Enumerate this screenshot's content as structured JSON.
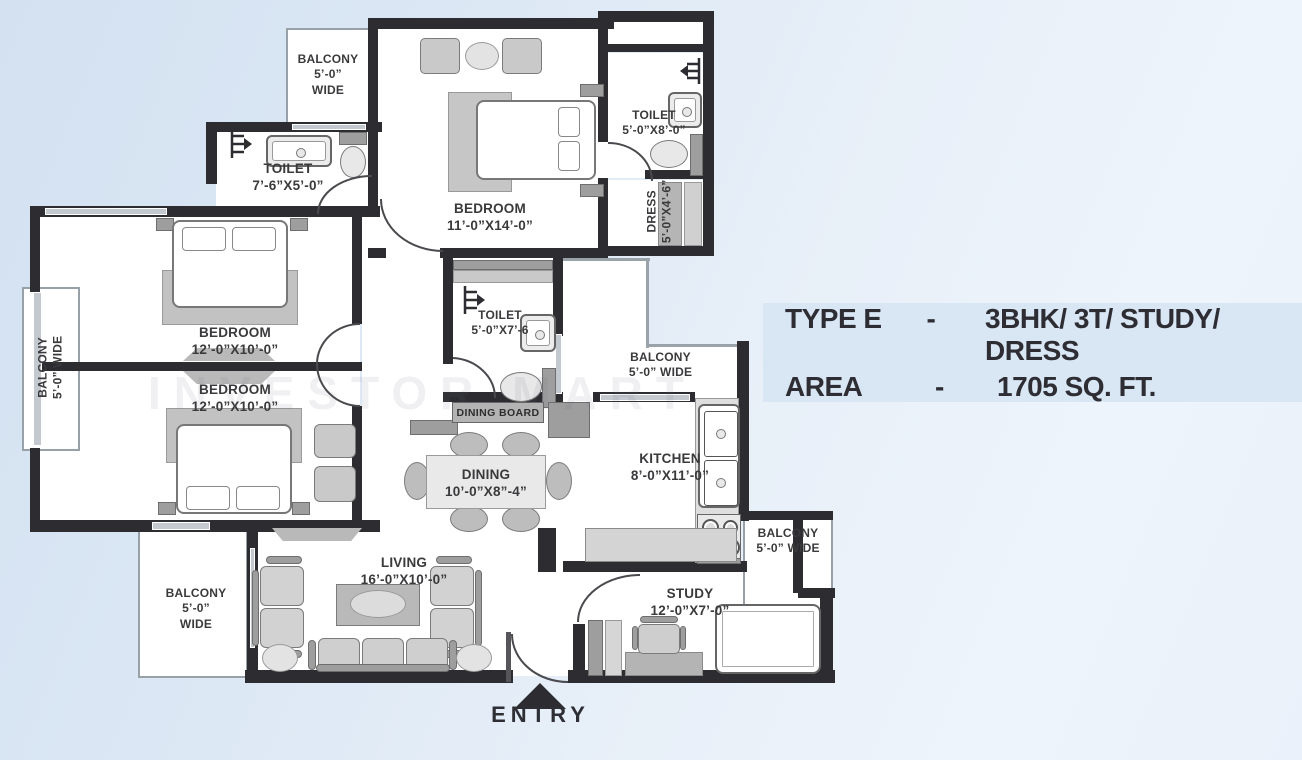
{
  "info_panel": {
    "rows": [
      {
        "label": "TYPE E",
        "sep": "-",
        "value": "3BHK/ 3T/ STUDY/ DRESS"
      },
      {
        "label": "AREA",
        "sep": "-",
        "value": "1705 SQ. FT."
      }
    ]
  },
  "labels": {
    "balcony_top_left": {
      "l1": "BALCONY",
      "l2": "5’-0”",
      "l3": "WIDE"
    },
    "toilet_top_left": {
      "l1": "TOILET",
      "l2": "7’-6”X5’-0”"
    },
    "bedroom_top": {
      "l1": "BEDROOM",
      "l2": "11’-0”X14’-0”"
    },
    "toilet_top_right": {
      "l1": "TOILET",
      "l2": "5’-0”X8’-0”"
    },
    "dress": {
      "l1": "DRESS",
      "l2": "5’-0”X4’-6”"
    },
    "bedroom_mid": {
      "l1": "BEDROOM",
      "l2": "12’-0”X10’-0”"
    },
    "bedroom_lower": {
      "l1": "BEDROOM",
      "l2": "12’-0”X10’-0”"
    },
    "balcony_left": {
      "l1": "BALCONY",
      "l2": "5’-0” WIDE"
    },
    "toilet_mid": {
      "l1": "TOILET",
      "l2": "5’-0”X7’-6"
    },
    "balcony_mid": {
      "l1": "BALCONY",
      "l2": "5’-0” WIDE"
    },
    "dining_board": {
      "l1": "DINING BOARD"
    },
    "dining": {
      "l1": "DINING",
      "l2": "10’-0”X8”-4”"
    },
    "kitchen": {
      "l1": "KITCHEN",
      "l2": "8’-0”X11’-0”"
    },
    "balcony_right": {
      "l1": "BALCONY",
      "l2": "5’-0” WIDE"
    },
    "living": {
      "l1": "LIVING",
      "l2": "16’-0”X10’-0”"
    },
    "balcony_bottom_left": {
      "l1": "BALCONY",
      "l2": "5’-0”",
      "l3": "WIDE"
    },
    "study": {
      "l1": "STUDY",
      "l2": "12’-0”X7’-0”"
    }
  },
  "entry": {
    "label": "ENTRY"
  },
  "watermark": "INVESTOR MART",
  "colors": {
    "wall": "#2c2c31",
    "background_top_left": "#d3e1f1",
    "background_right": "#eef4fb",
    "panel_background": "#d9e6f4",
    "label_text": "#3a3a3c",
    "furniture_gray": "#c9c9c9"
  }
}
